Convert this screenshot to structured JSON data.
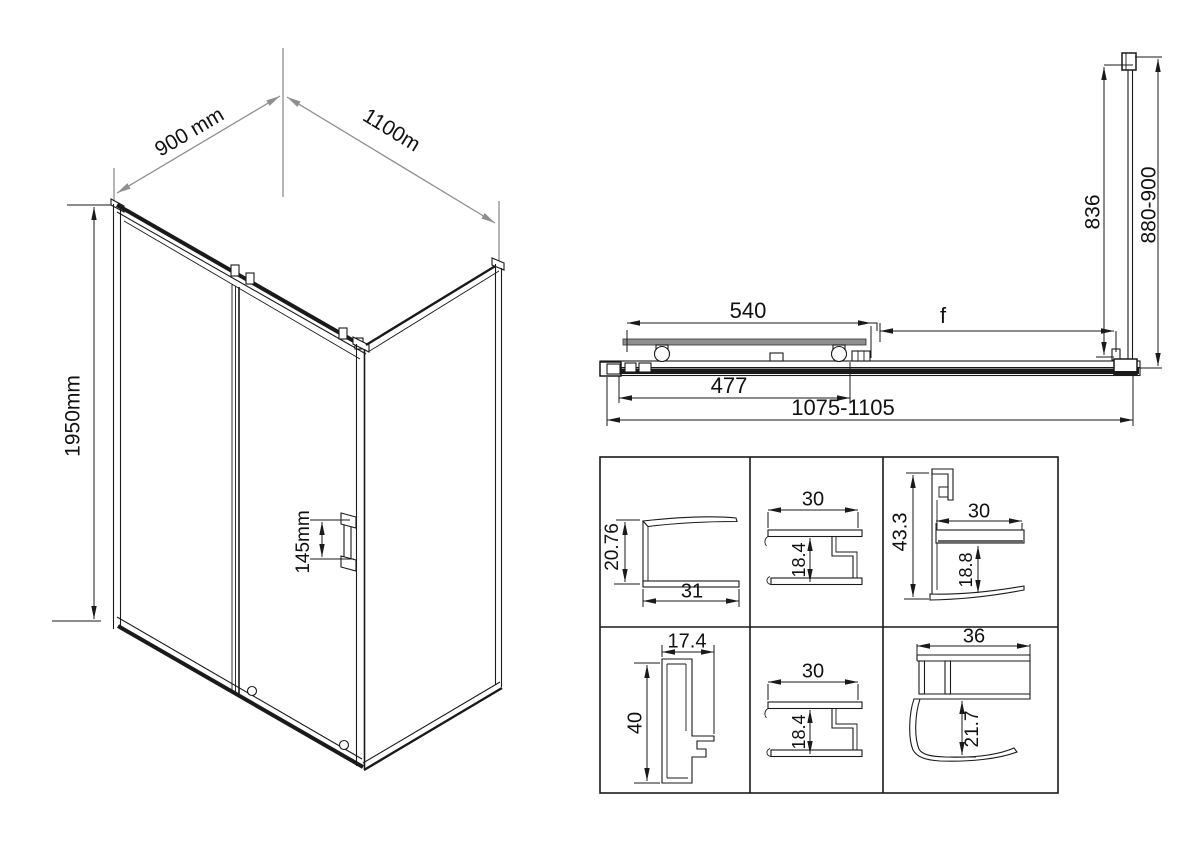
{
  "colors": {
    "line": "#1a1a1a",
    "construction_gray": "#8f8f8f",
    "glass_shade": "#8f8f8f",
    "background": "#ffffff"
  },
  "iso": {
    "depth": "900 mm",
    "width": "1100m",
    "height": "1950mm",
    "handle": "145mm"
  },
  "plan": {
    "door": "540",
    "panel": "f",
    "glass": "477",
    "total": "1075-1105",
    "inner": "836",
    "side": "880-900"
  },
  "profiles": {
    "c1": {
      "h": "20.76",
      "w": "31"
    },
    "c2": {
      "w": "30",
      "h": "18.4"
    },
    "c3": {
      "v": "43.3",
      "w": "30",
      "h": "18.8"
    },
    "c4": {
      "w": "17.4",
      "h": "40"
    },
    "c5": {
      "w": "30",
      "h": "18.4"
    },
    "c6": {
      "w": "36",
      "h": "21.7"
    }
  }
}
